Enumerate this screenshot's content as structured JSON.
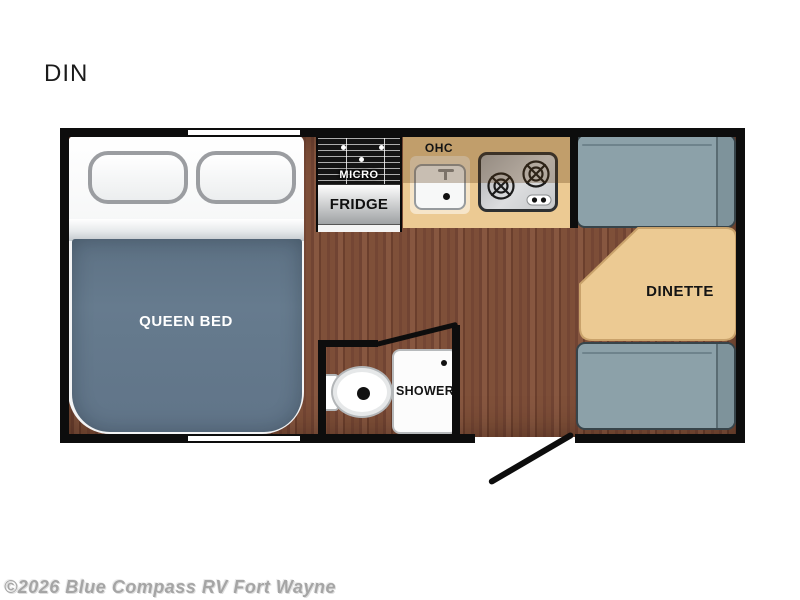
{
  "page": {
    "title_label": "DIN",
    "watermark": "©2026 Blue Compass RV Fort Wayne"
  },
  "floorplan": {
    "bed": {
      "label": "QUEEN BED"
    },
    "kitchen": {
      "microwave_label": "MICRO",
      "fridge_label": "FRIDGE",
      "overhead_cabinet_label": "OHC"
    },
    "dinette": {
      "label": "DINETTE"
    },
    "bathroom": {
      "shower_label": "SHOWER"
    }
  },
  "colors": {
    "wall": "#0d0d0d",
    "floor-wood": "#7b4c37",
    "counter": "#ecca93",
    "ohc-overlay": "rgba(94,56,16,0.30)",
    "table": "#ecca93",
    "table-outline": "#c9a26b",
    "bench": "#8ca1a9",
    "bench-back": "#7e939b",
    "blanket": "#667b8e"
  }
}
